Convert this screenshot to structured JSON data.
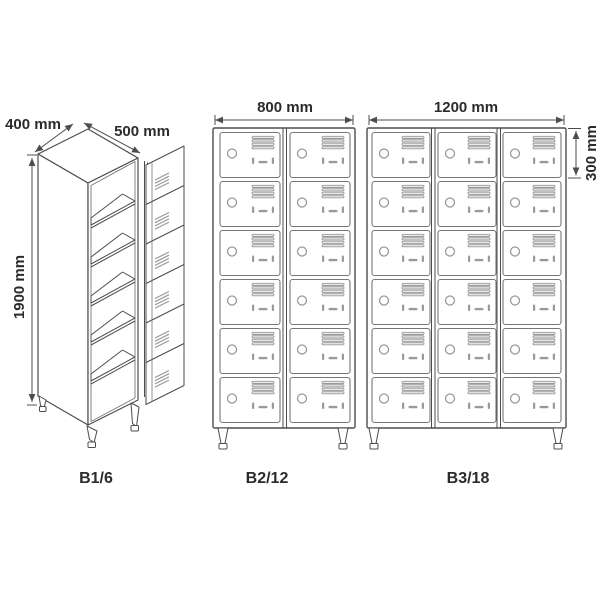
{
  "title": "Metal compartment locker size diagram",
  "colors": {
    "background": "#ffffff",
    "line": "#4d4d4d",
    "line_light": "#777777",
    "detail": "#9a9a9a",
    "detail_fill": "#e9e9e9",
    "text": "#2b2b2b"
  },
  "icons": {
    "lock": "circle-lock-icon",
    "vents": "vent-slats-icon",
    "handle": "recessed-handle-icon"
  },
  "lockers": [
    {
      "name": "B1/6",
      "view": "isometric",
      "columns": 1,
      "rows": 6,
      "doors": 6,
      "dims": {
        "depth": "400 mm",
        "width": "500 mm",
        "height": "1900 mm"
      }
    },
    {
      "name": "B2/12",
      "view": "front",
      "columns": 2,
      "rows": 6,
      "doors": 12,
      "dims": {
        "width": "800 mm"
      }
    },
    {
      "name": "B3/18",
      "view": "front",
      "columns": 3,
      "rows": 6,
      "doors": 18,
      "dims": {
        "width": "1200 mm",
        "compartment_height": "300 mm"
      }
    }
  ]
}
